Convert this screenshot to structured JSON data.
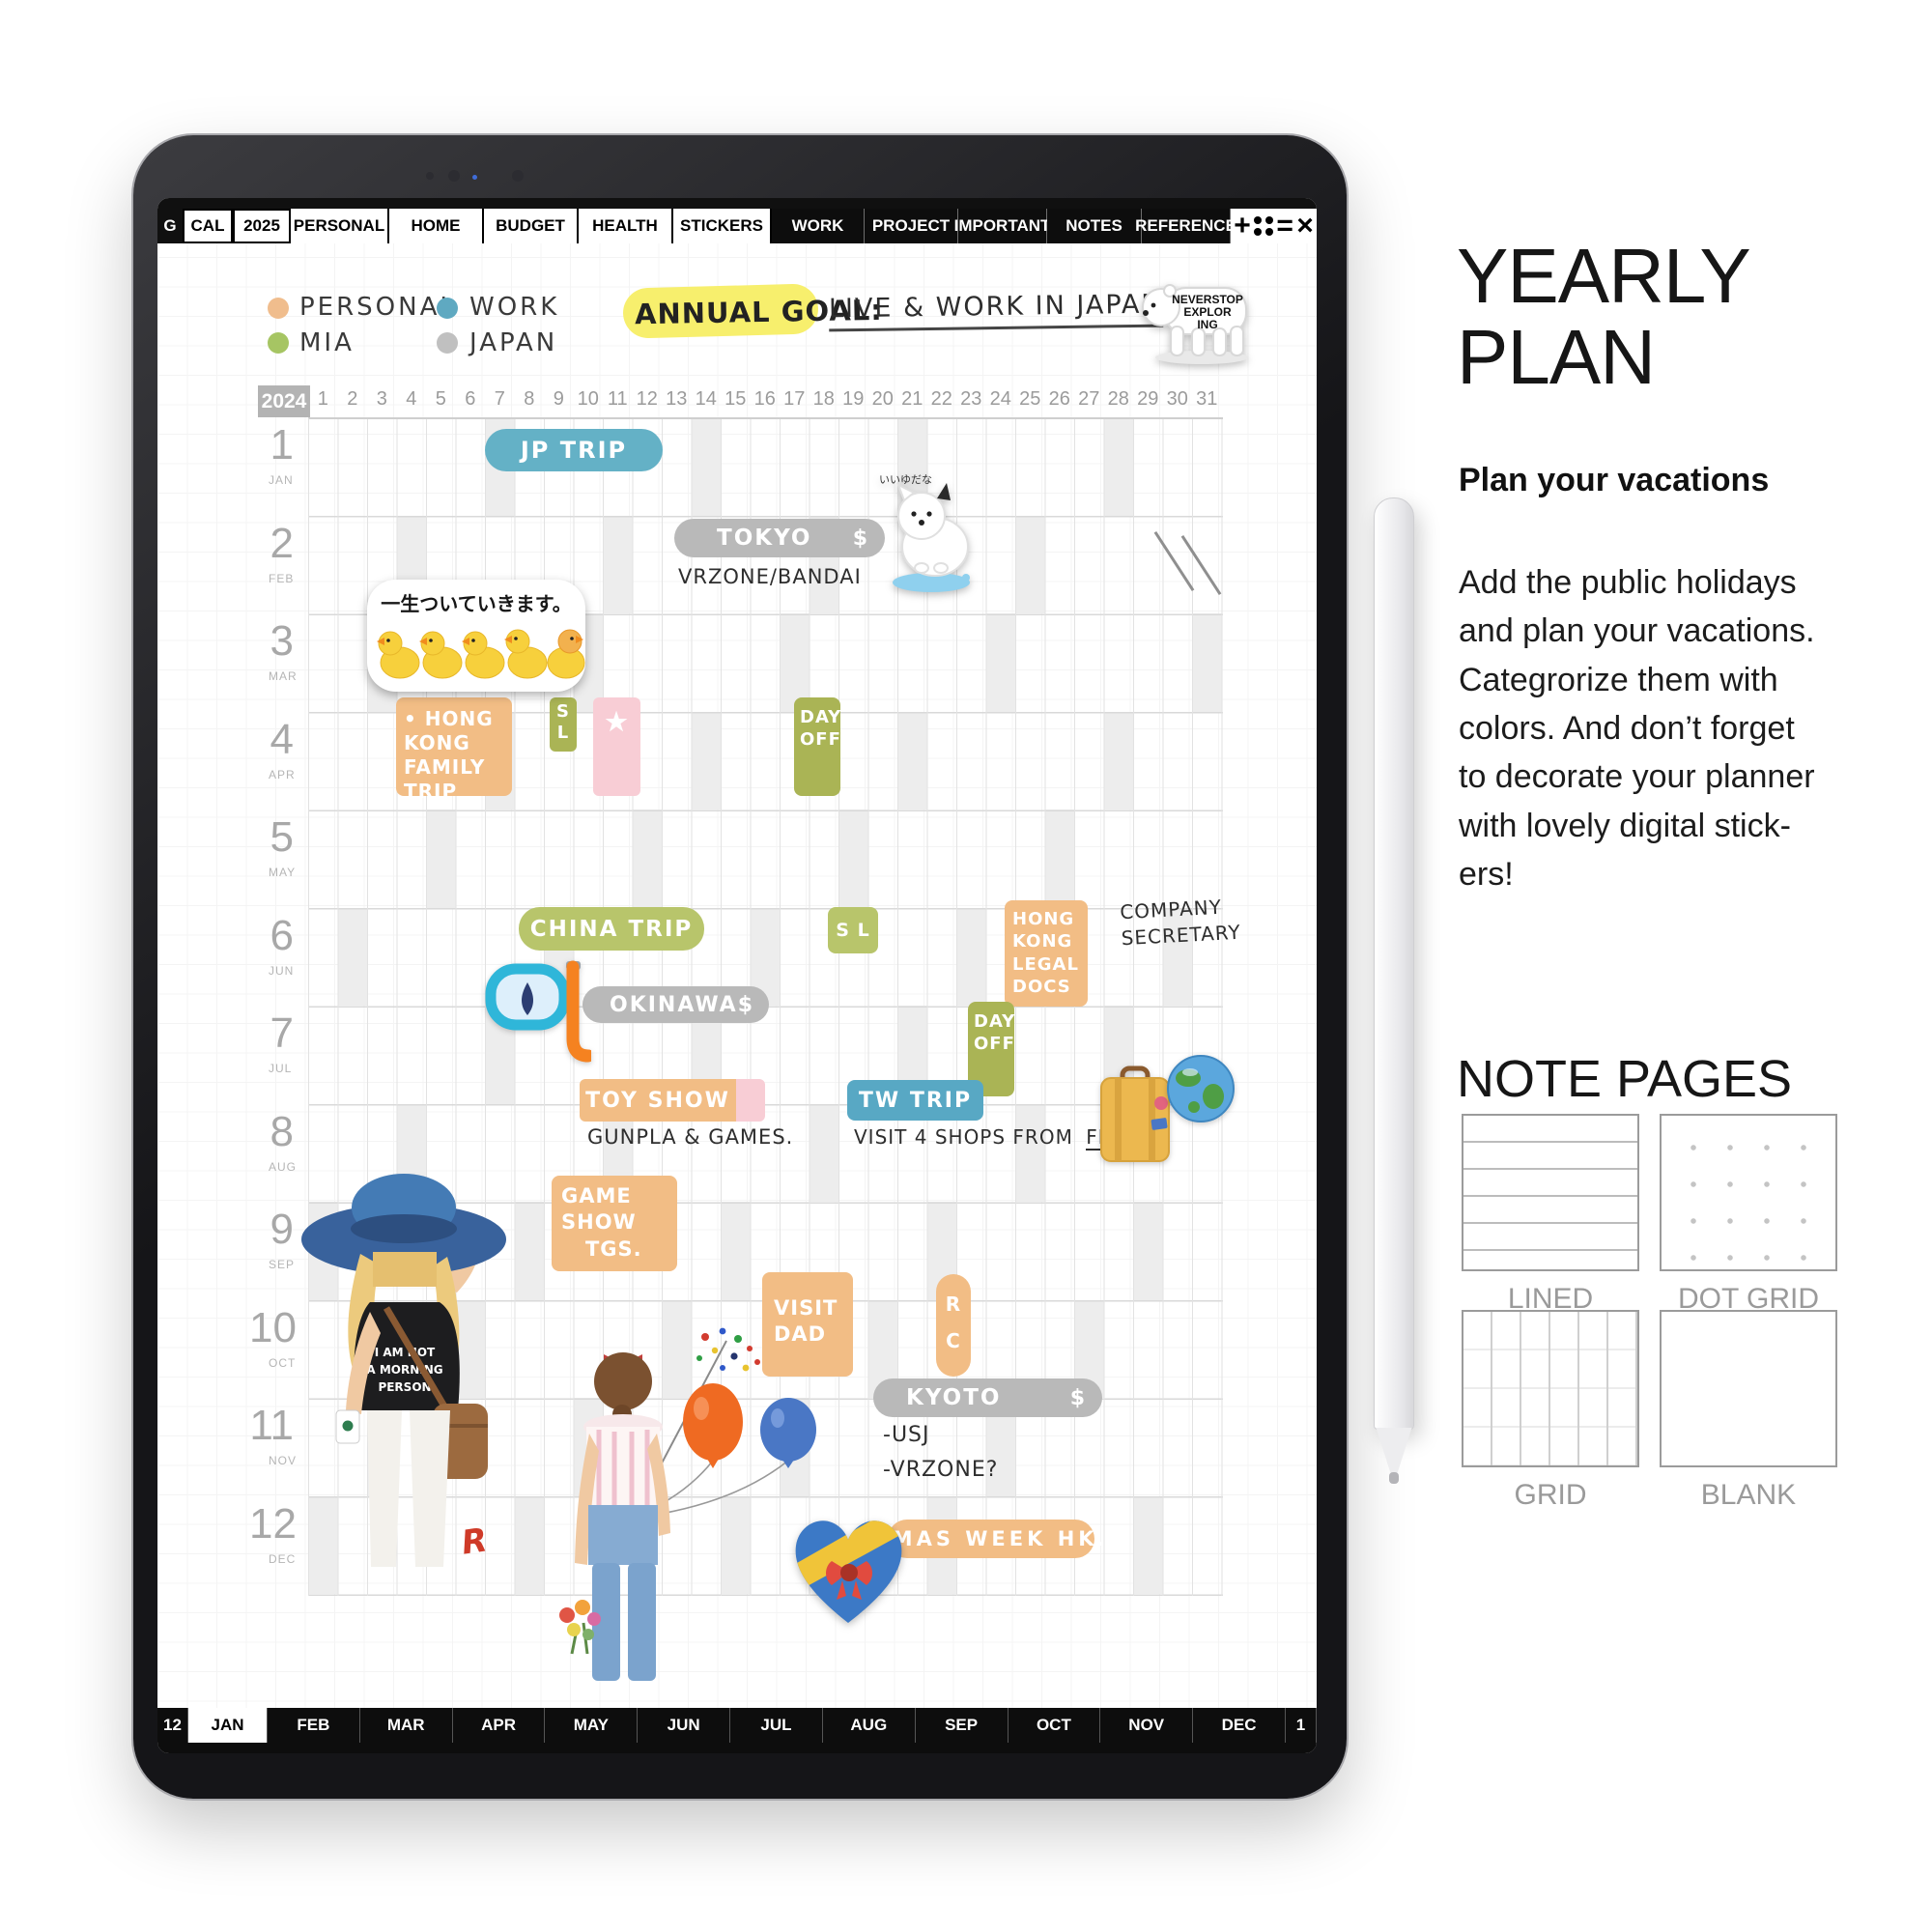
{
  "top_tabs": {
    "g": "G",
    "tabs_light": [
      "CAL",
      "2025",
      "PERSONAL",
      "HOME",
      "BUDGET",
      "HEALTH",
      "STICKERS"
    ],
    "tabs_dark": [
      "WORK",
      "PROJECT",
      "IMPORTANT",
      "NOTES",
      "REFERENCE"
    ],
    "icons": {
      "plus": "+",
      "menu": "=",
      "close": "×"
    }
  },
  "legend": {
    "items": [
      {
        "label": "PERSONAL",
        "color": "#f0bd8d"
      },
      {
        "label": "WORK",
        "color": "#5fa9c1"
      },
      {
        "label": "MIA",
        "color": "#a6c563"
      },
      {
        "label": "JAPAN",
        "color": "#c0c0c0"
      }
    ]
  },
  "goal": {
    "label": "ANNUAL GOAL:",
    "value": "LIVE & WORK IN JAPAN"
  },
  "calendar": {
    "year": "2024",
    "day_count": 31,
    "months": [
      {
        "n": "1",
        "abbr": "JAN"
      },
      {
        "n": "2",
        "abbr": "FEB"
      },
      {
        "n": "3",
        "abbr": "MAR"
      },
      {
        "n": "4",
        "abbr": "APR"
      },
      {
        "n": "5",
        "abbr": "MAY"
      },
      {
        "n": "6",
        "abbr": "JUN"
      },
      {
        "n": "7",
        "abbr": "JUL"
      },
      {
        "n": "8",
        "abbr": "AUG"
      },
      {
        "n": "9",
        "abbr": "SEP"
      },
      {
        "n": "10",
        "abbr": "OCT"
      },
      {
        "n": "11",
        "abbr": "NOV"
      },
      {
        "n": "12",
        "abbr": "DEC"
      }
    ],
    "sundays": [
      [
        7,
        14,
        21,
        28
      ],
      [
        4,
        11,
        18,
        25
      ],
      [
        3,
        10,
        17,
        24,
        31
      ],
      [
        7,
        14,
        21,
        28
      ],
      [
        5,
        12,
        19,
        26
      ],
      [
        2,
        9,
        16,
        23,
        30
      ],
      [
        7,
        14,
        21,
        28
      ],
      [
        4,
        11,
        18,
        25
      ],
      [
        1,
        8,
        15,
        22,
        29
      ],
      [
        6,
        13,
        20,
        27
      ],
      [
        3,
        10,
        17,
        24
      ],
      [
        1,
        8,
        15,
        22,
        29
      ]
    ],
    "entries": {
      "jp_trip": {
        "text": "JP TRIP"
      },
      "tokyo": {
        "text": "TOKYO",
        "cost": "$",
        "note": "VRZONE/BANDAI"
      },
      "hk_family": {
        "text": "• HONG KONG\nFAMILY TRIP"
      },
      "sl_apr": {
        "text": "S\nL"
      },
      "star": {
        "icon": "★"
      },
      "day_off_apr": {
        "text": "DAY\nOFF"
      },
      "china_trip": {
        "text": "CHINA TRIP"
      },
      "sl_jun": {
        "text": "S L"
      },
      "hk_legal": {
        "text": "HONG KONG\nLEGAL\nDOCS"
      },
      "company_note": {
        "text": "COMPANY\nSECRETARY"
      },
      "okinawa": {
        "text": "OKINAWA",
        "cost": "$"
      },
      "day_off_jul": {
        "text": "DAY\nOFF"
      },
      "toy_show": {
        "text": "TOY SHOW",
        "note": "GUNPLA & GAMES."
      },
      "tw_trip": {
        "text": "TW TRIP",
        "note": "VISIT 4 SHOPS FROM",
        "note_underlined": "FEB"
      },
      "game_show": {
        "text": "GAME\nSHOW\n   TGS."
      },
      "visit_dad": {
        "text": "VISIT\nDAD"
      },
      "rc": {
        "text": "R\nC"
      },
      "kyoto": {
        "text": "KYOTO",
        "cost": "$",
        "note": "-USJ\n-VRZONE?"
      },
      "xmas": {
        "text": "XMAS WEEK HK."
      }
    }
  },
  "stickers": {
    "bear": {
      "l1": "NEVERSTOP",
      "l2": "EXPLOR",
      "l3": "ING"
    },
    "ducks_text": "一生ついていきます。",
    "dog_text": "いいゆだな",
    "tshirt": {
      "l1": "I AM NOT",
      "l2": "A MORNING",
      "l3": "PERSON"
    },
    "signature": "R"
  },
  "bottom_tabs": {
    "left": "12",
    "active": "JAN",
    "others": [
      "FEB",
      "MAR",
      "APR",
      "MAY",
      "JUN",
      "JUL",
      "AUG",
      "SEP",
      "OCT",
      "NOV",
      "DEC"
    ],
    "right": "1"
  },
  "panel": {
    "title": "YEARLY\nPLAN",
    "subtitle": "Plan your vacations",
    "body": "Add the public holidays\nand plan your vacations.\nCategrorize them with\ncolors. And don’t forget\nto decorate your planner\nwith lovely digital stick-\ners!",
    "note_title": "NOTE PAGES",
    "note_types": [
      "LINED",
      "DOT GRID",
      "GRID",
      "BLANK"
    ]
  },
  "colors": {
    "personal_orange": "#f2bd85",
    "work_blue": "#64b1c6",
    "mia_green": "#a6c563",
    "japan_gray": "#b9b9b9",
    "olive_dayoff": "#aab455",
    "pink_block": "#f8cdd5",
    "yellow_highlight": "#f7ef6d",
    "tab_black": "#111111"
  }
}
